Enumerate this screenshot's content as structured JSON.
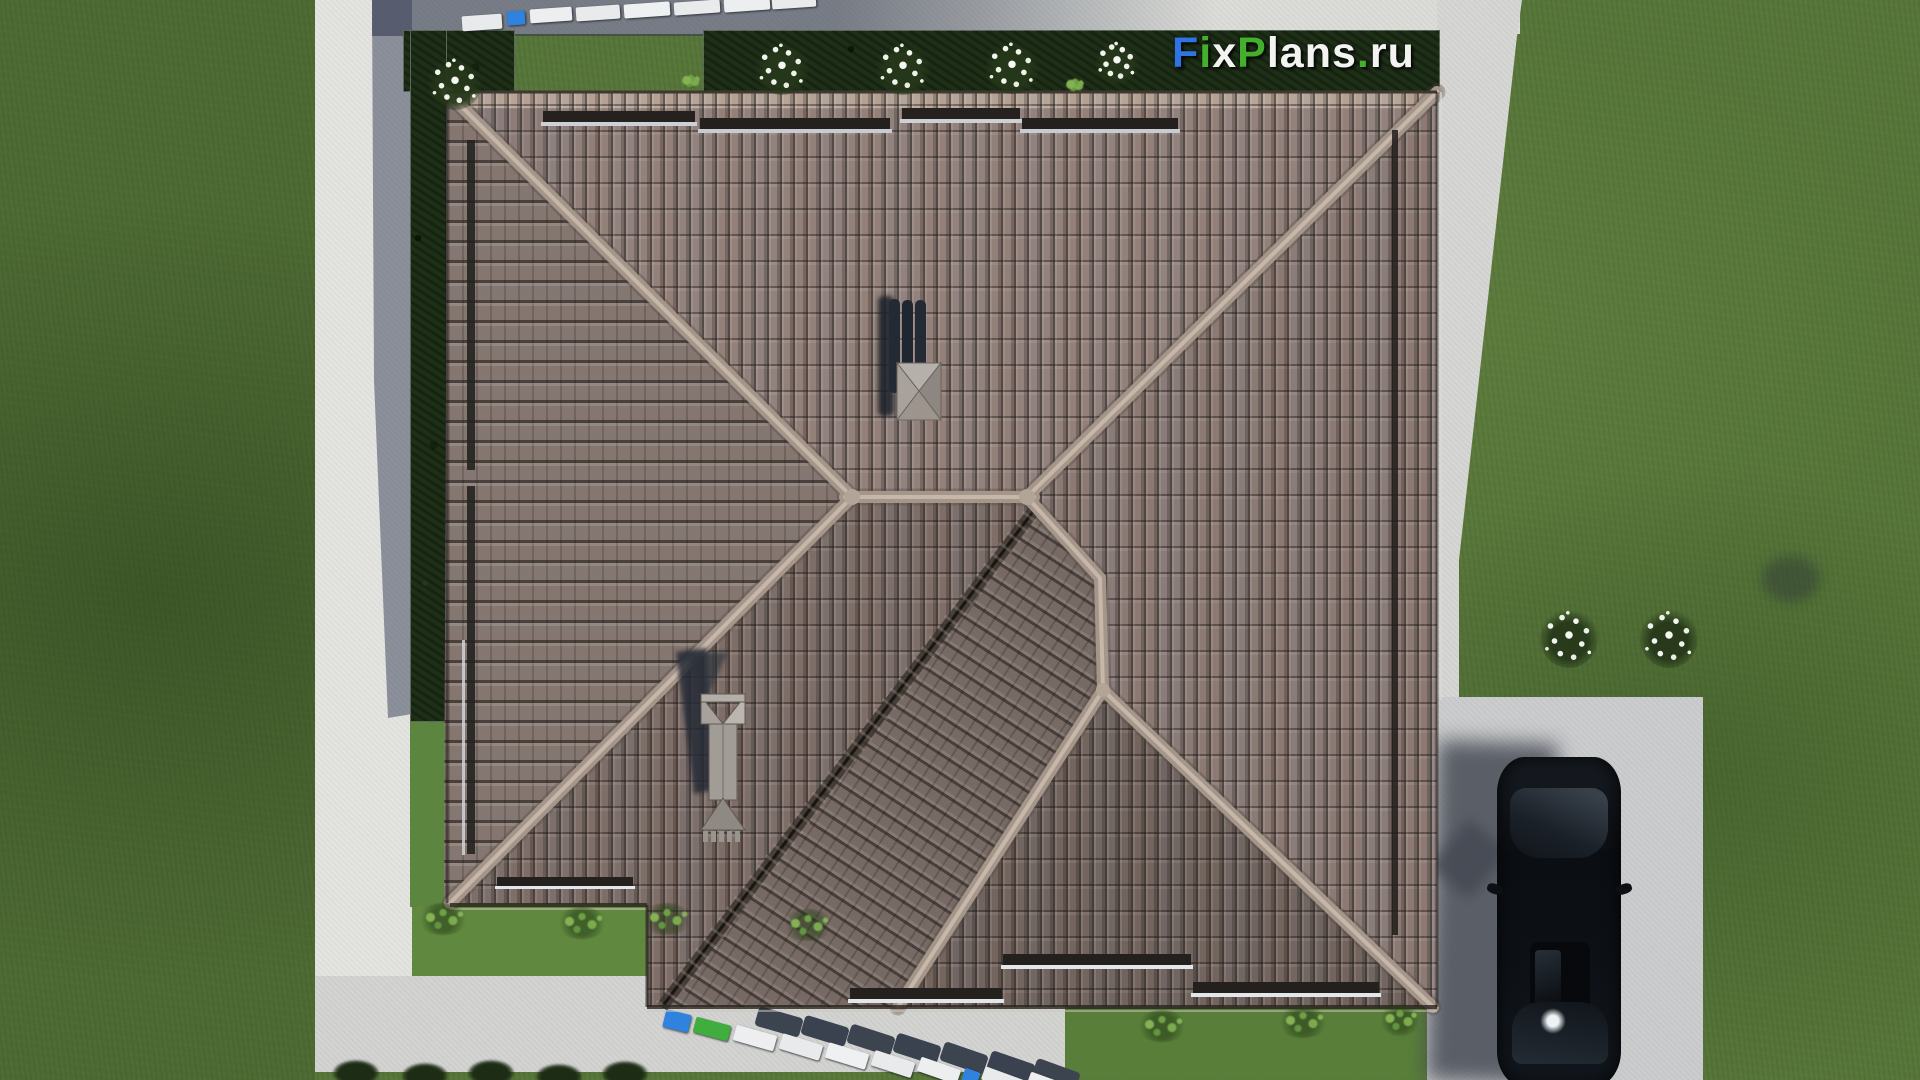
{
  "watermark": {
    "text": "FixPlans.ru",
    "segments": [
      {
        "text": "F",
        "color": "#2f74e2"
      },
      {
        "text": "i",
        "color": "#43af2d"
      },
      {
        "text": "x",
        "color": "#f3f4f2"
      },
      {
        "text": "P",
        "color": "#43af2d"
      },
      {
        "text": "lans",
        "color": "#f3f4f2"
      },
      {
        "text": ".",
        "color": "#43af2d"
      },
      {
        "text": "ru",
        "color": "#f3f4f2"
      }
    ]
  },
  "palette": {
    "grass": "#57763a",
    "roof_tile": "#8b7b74",
    "roof_ridge": "#a5968b",
    "concrete": "#dcddd9",
    "shadow_blue": "#4e5668",
    "hedge_green": "#1e2f17",
    "truck_blue": "#2f82dd",
    "truck_green": "#3fae3f",
    "car_black": "#0d1116"
  },
  "scene": {
    "description": "Top-down 3D render of a hip tiled roof of a house surrounded by lawn, concrete paths, hedges, flowering bushes, delivery truck convoys and a parked black car"
  }
}
